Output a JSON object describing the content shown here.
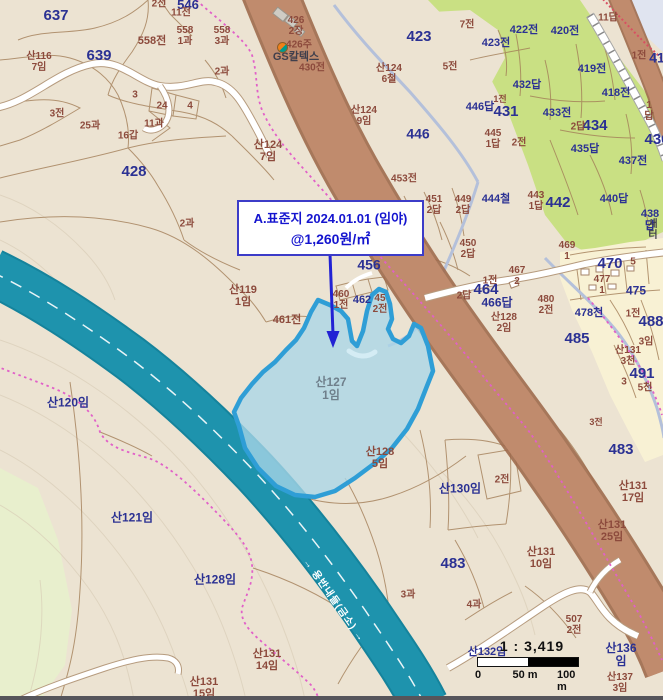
{
  "colors": {
    "land": "#ece3d2",
    "green_field": "#c9e083",
    "pale_green": "#e8efcd",
    "village_yellow": "#f8f1d4",
    "water_corner": "#e0e4f0",
    "river": "#1e93ad",
    "river_casing": "#15839c",
    "stream": "#b4c0da",
    "road_brown": "#c08b6d",
    "road_brown_edge": "#9e6a4c",
    "road_casing": "#b69b7e",
    "parcel_line": "#a37e58",
    "boundary_pink": "#e160c8",
    "boundary_red": "#d94f62",
    "contour": "#d8ccb6",
    "highlight_fill": "#a9d6e8",
    "highlight_stroke": "#2f9ed6",
    "lagoon": "#d4ecf4",
    "label_blue": "#2b3193",
    "label_brown": "#8c4a3c",
    "label_gray": "#6f7f8b",
    "label_dark": "#403f4c",
    "label_white": "#ffffff",
    "annotation_blue": "#1414cf",
    "annotation_border": "#3c3cc8",
    "scale_black": "#111111"
  },
  "map": {
    "annotation": {
      "line1": "A.표준지 2024.01.01 (임야)",
      "line2": "@1,260원/㎡"
    },
    "scale": {
      "ratio": "1 : 3,419",
      "ticks": [
        "0",
        "50 m",
        "100 m"
      ]
    },
    "labels": [
      {
        "t": "2전",
        "x": 159,
        "y": 5,
        "c": "brown",
        "s": 10
      },
      {
        "t": "546",
        "x": 188,
        "y": 5,
        "c": "blue",
        "s": 13
      },
      {
        "t": "11전",
        "x": 181,
        "y": 14,
        "c": "brown",
        "s": 10
      },
      {
        "t": "637",
        "x": 56,
        "y": 16,
        "c": "blue",
        "s": 15
      },
      {
        "t": "639",
        "x": 99,
        "y": 56,
        "c": "blue",
        "s": 15
      },
      {
        "t": "558전",
        "x": 152,
        "y": 42,
        "c": "brown",
        "s": 11
      },
      {
        "t": "558\n1과",
        "x": 185,
        "y": 37,
        "c": "brown",
        "s": 10
      },
      {
        "t": "558\n3과",
        "x": 222,
        "y": 37,
        "c": "brown",
        "s": 10
      },
      {
        "t": "산116\n7임",
        "x": 39,
        "y": 63,
        "c": "brown",
        "s": 10
      },
      {
        "t": "426\n2장",
        "x": 296,
        "y": 27,
        "c": "brown",
        "s": 10
      },
      {
        "t": "426주",
        "x": 299,
        "y": 46,
        "c": "brown",
        "s": 10
      },
      {
        "t": "GS칼텍스",
        "x": 296,
        "y": 58,
        "c": "dark",
        "s": 11
      },
      {
        "t": "430전",
        "x": 312,
        "y": 69,
        "c": "brown",
        "s": 10
      },
      {
        "t": "3전",
        "x": 57,
        "y": 115,
        "c": "brown",
        "s": 10
      },
      {
        "t": "25과",
        "x": 90,
        "y": 127,
        "c": "brown",
        "s": 10
      },
      {
        "t": "16갑",
        "x": 128,
        "y": 137,
        "c": "brown",
        "s": 10
      },
      {
        "t": "11과",
        "x": 154,
        "y": 125,
        "c": "brown",
        "s": 10
      },
      {
        "t": "24",
        "x": 162,
        "y": 107,
        "c": "brown",
        "s": 10
      },
      {
        "t": "3",
        "x": 135,
        "y": 96,
        "c": "brown",
        "s": 10
      },
      {
        "t": "4",
        "x": 190,
        "y": 107,
        "c": "brown",
        "s": 10
      },
      {
        "t": "2과",
        "x": 222,
        "y": 73,
        "c": "brown",
        "s": 10
      },
      {
        "t": "428",
        "x": 134,
        "y": 172,
        "c": "blue",
        "s": 15
      },
      {
        "t": "산124\n7임",
        "x": 268,
        "y": 152,
        "c": "brown",
        "s": 11
      },
      {
        "t": "423",
        "x": 419,
        "y": 37,
        "c": "blue",
        "s": 15
      },
      {
        "t": "7전",
        "x": 467,
        "y": 26,
        "c": "brown",
        "s": 10
      },
      {
        "t": "5전",
        "x": 450,
        "y": 68,
        "c": "brown",
        "s": 10
      },
      {
        "t": "423전",
        "x": 496,
        "y": 44,
        "c": "blue",
        "s": 11
      },
      {
        "t": "422전",
        "x": 524,
        "y": 31,
        "c": "blue",
        "s": 11
      },
      {
        "t": "420전",
        "x": 565,
        "y": 32,
        "c": "blue",
        "s": 11
      },
      {
        "t": "11답",
        "x": 608,
        "y": 19,
        "c": "brown",
        "s": 10
      },
      {
        "t": "419전",
        "x": 592,
        "y": 70,
        "c": "blue",
        "s": 11
      },
      {
        "t": "432답",
        "x": 527,
        "y": 86,
        "c": "blue",
        "s": 11
      },
      {
        "t": "433전",
        "x": 557,
        "y": 114,
        "c": "blue",
        "s": 11
      },
      {
        "t": "418전",
        "x": 616,
        "y": 94,
        "c": "blue",
        "s": 11
      },
      {
        "t": "1전",
        "x": 639,
        "y": 57,
        "c": "brown",
        "s": 10
      },
      {
        "t": "41",
        "x": 657,
        "y": 58,
        "c": "blue",
        "s": 14
      },
      {
        "t": "산124\n6철",
        "x": 389,
        "y": 75,
        "c": "brown",
        "s": 10
      },
      {
        "t": "산124\n9임",
        "x": 364,
        "y": 117,
        "c": "brown",
        "s": 10
      },
      {
        "t": "446",
        "x": 418,
        "y": 134,
        "c": "blue",
        "s": 14
      },
      {
        "t": "1전",
        "x": 500,
        "y": 100,
        "c": "brown",
        "s": 9
      },
      {
        "t": "446답",
        "x": 480,
        "y": 108,
        "c": "blue",
        "s": 11
      },
      {
        "t": "431",
        "x": 506,
        "y": 112,
        "c": "blue",
        "s": 15
      },
      {
        "t": "445\n1답",
        "x": 493,
        "y": 140,
        "c": "brown",
        "s": 10
      },
      {
        "t": "2전",
        "x": 519,
        "y": 144,
        "c": "brown",
        "s": 10
      },
      {
        "t": "434",
        "x": 595,
        "y": 126,
        "c": "blue",
        "s": 15
      },
      {
        "t": "2답",
        "x": 578,
        "y": 128,
        "c": "brown",
        "s": 10
      },
      {
        "t": "1답",
        "x": 649,
        "y": 112,
        "c": "brown",
        "s": 10
      },
      {
        "t": "436",
        "x": 657,
        "y": 140,
        "c": "blue",
        "s": 15
      },
      {
        "t": "435답",
        "x": 585,
        "y": 150,
        "c": "blue",
        "s": 11
      },
      {
        "t": "437전",
        "x": 633,
        "y": 162,
        "c": "blue",
        "s": 11
      },
      {
        "t": "440답",
        "x": 614,
        "y": 200,
        "c": "blue",
        "s": 11
      },
      {
        "t": "438답",
        "x": 650,
        "y": 221,
        "c": "blue",
        "s": 11
      },
      {
        "t": "새터",
        "x": 653,
        "y": 231,
        "c": "dark",
        "s": 10
      },
      {
        "t": "453전",
        "x": 404,
        "y": 180,
        "c": "brown",
        "s": 10
      },
      {
        "t": "451\n2답",
        "x": 434,
        "y": 206,
        "c": "brown",
        "s": 10
      },
      {
        "t": "449\n2답",
        "x": 463,
        "y": 206,
        "c": "brown",
        "s": 10
      },
      {
        "t": "444철",
        "x": 496,
        "y": 200,
        "c": "blue",
        "s": 11
      },
      {
        "t": "443\n1답",
        "x": 536,
        "y": 202,
        "c": "brown",
        "s": 10
      },
      {
        "t": "442",
        "x": 558,
        "y": 203,
        "c": "blue",
        "s": 15
      },
      {
        "t": "450\n2답",
        "x": 468,
        "y": 250,
        "c": "brown",
        "s": 10
      },
      {
        "t": "2과",
        "x": 187,
        "y": 225,
        "c": "brown",
        "s": 10
      },
      {
        "t": "456",
        "x": 369,
        "y": 265,
        "c": "blue",
        "s": 14
      },
      {
        "t": "산119\n1임",
        "x": 243,
        "y": 297,
        "c": "brown",
        "s": 11
      },
      {
        "t": "461전",
        "x": 287,
        "y": 321,
        "c": "brown",
        "s": 11
      },
      {
        "t": "460\n1전",
        "x": 341,
        "y": 301,
        "c": "brown",
        "s": 10
      },
      {
        "t": "462",
        "x": 362,
        "y": 301,
        "c": "blue",
        "s": 11
      },
      {
        "t": "45\n2전",
        "x": 380,
        "y": 305,
        "c": "brown",
        "s": 10
      },
      {
        "t": "469\n1",
        "x": 567,
        "y": 252,
        "c": "brown",
        "s": 10
      },
      {
        "t": "470",
        "x": 610,
        "y": 264,
        "c": "blue",
        "s": 15
      },
      {
        "t": "5",
        "x": 633,
        "y": 263,
        "c": "brown",
        "s": 10
      },
      {
        "t": "467\n2",
        "x": 517,
        "y": 277,
        "c": "brown",
        "s": 10
      },
      {
        "t": "1전",
        "x": 490,
        "y": 282,
        "c": "brown",
        "s": 10
      },
      {
        "t": "464",
        "x": 486,
        "y": 290,
        "c": "blue",
        "s": 15
      },
      {
        "t": "2답",
        "x": 464,
        "y": 297,
        "c": "brown",
        "s": 10
      },
      {
        "t": "466답",
        "x": 497,
        "y": 303,
        "c": "blue",
        "s": 12
      },
      {
        "t": "475",
        "x": 636,
        "y": 291,
        "c": "blue",
        "s": 12
      },
      {
        "t": "477\n1",
        "x": 602,
        "y": 286,
        "c": "brown",
        "s": 10
      },
      {
        "t": "480\n2전",
        "x": 546,
        "y": 306,
        "c": "brown",
        "s": 10
      },
      {
        "t": "산128\n2임",
        "x": 504,
        "y": 324,
        "c": "brown",
        "s": 10
      },
      {
        "t": "478천",
        "x": 589,
        "y": 314,
        "c": "blue",
        "s": 11
      },
      {
        "t": "485",
        "x": 577,
        "y": 339,
        "c": "blue",
        "s": 15
      },
      {
        "t": "488",
        "x": 651,
        "y": 322,
        "c": "blue",
        "s": 15
      },
      {
        "t": "1전",
        "x": 633,
        "y": 315,
        "c": "brown",
        "s": 10
      },
      {
        "t": "3임",
        "x": 646,
        "y": 343,
        "c": "brown",
        "s": 10
      },
      {
        "t": "산131\n3천",
        "x": 628,
        "y": 357,
        "c": "brown",
        "s": 10
      },
      {
        "t": "491",
        "x": 642,
        "y": 374,
        "c": "blue",
        "s": 15
      },
      {
        "t": "3",
        "x": 624,
        "y": 383,
        "c": "brown",
        "s": 10
      },
      {
        "t": "5천",
        "x": 645,
        "y": 389,
        "c": "brown",
        "s": 10
      },
      {
        "t": "3전",
        "x": 596,
        "y": 423,
        "c": "brown",
        "s": 9
      },
      {
        "t": "산127\n1임",
        "x": 331,
        "y": 389,
        "c": "gray",
        "s": 12
      },
      {
        "t": "산120임",
        "x": 68,
        "y": 403,
        "c": "blue",
        "s": 12
      },
      {
        "t": "산128\n5임",
        "x": 380,
        "y": 459,
        "c": "brown",
        "s": 11
      },
      {
        "t": "483",
        "x": 621,
        "y": 450,
        "c": "blue",
        "s": 15
      },
      {
        "t": "산131\n17임",
        "x": 633,
        "y": 493,
        "c": "brown",
        "s": 11
      },
      {
        "t": "산130임",
        "x": 460,
        "y": 489,
        "c": "blue",
        "s": 12
      },
      {
        "t": "2전",
        "x": 502,
        "y": 481,
        "c": "brown",
        "s": 10
      },
      {
        "t": "산131\n25임",
        "x": 612,
        "y": 532,
        "c": "brown",
        "s": 11
      },
      {
        "t": "산121임",
        "x": 132,
        "y": 518,
        "c": "blue",
        "s": 12
      },
      {
        "t": "산131\n10임",
        "x": 541,
        "y": 559,
        "c": "brown",
        "s": 11
      },
      {
        "t": "483",
        "x": 453,
        "y": 564,
        "c": "blue",
        "s": 15
      },
      {
        "t": "산128임",
        "x": 215,
        "y": 580,
        "c": "blue",
        "s": 12
      },
      {
        "t": "3과",
        "x": 408,
        "y": 596,
        "c": "brown",
        "s": 10
      },
      {
        "t": "4과",
        "x": 474,
        "y": 606,
        "c": "brown",
        "s": 10
      },
      {
        "t": "산131\n14임",
        "x": 267,
        "y": 661,
        "c": "brown",
        "s": 11
      },
      {
        "t": "산131\n15임",
        "x": 204,
        "y": 689,
        "c": "brown",
        "s": 11
      },
      {
        "t": "507\n2전",
        "x": 574,
        "y": 626,
        "c": "brown",
        "s": 10
      },
      {
        "t": "산136임",
        "x": 621,
        "y": 655,
        "c": "blue",
        "s": 12
      },
      {
        "t": "산137\n3임",
        "x": 620,
        "y": 684,
        "c": "brown",
        "s": 10
      },
      {
        "t": "산132임",
        "x": 487,
        "y": 653,
        "c": "blue",
        "s": 11
      },
      {
        "t": "→ 용반내들(금소) →",
        "x": 333,
        "y": 601,
        "c": "white",
        "s": 10,
        "r": 55,
        "ls": 1
      }
    ]
  }
}
